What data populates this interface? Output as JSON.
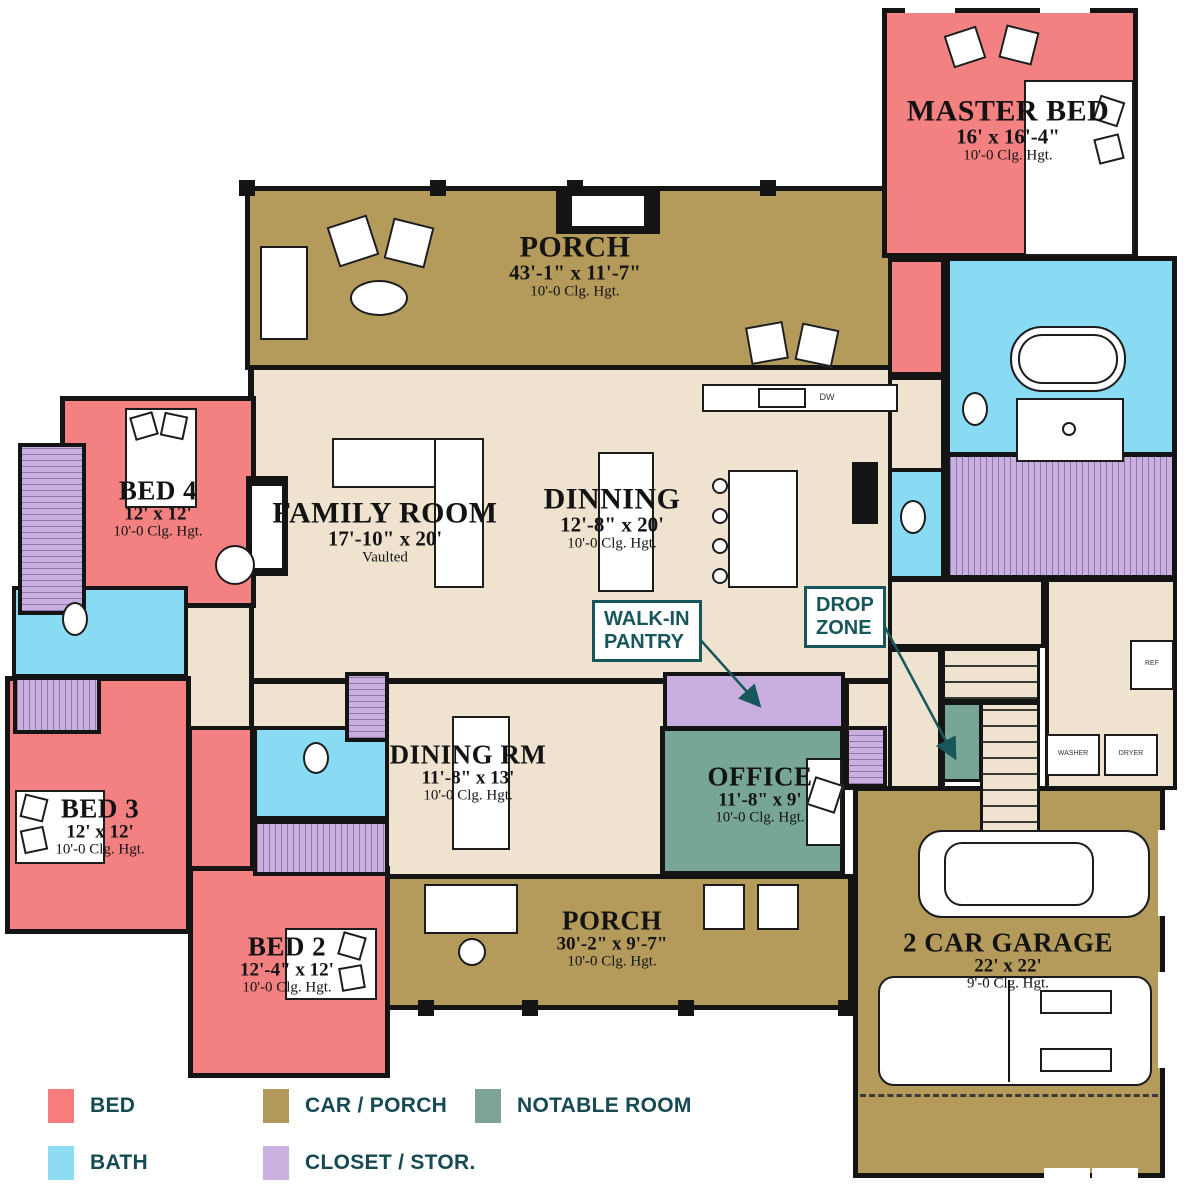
{
  "rooms": {
    "porch_top": {
      "name": "PORCH",
      "dims": "43'-1\" x 11'-7\"",
      "clg": "10'-0 Clg. Hgt."
    },
    "master_bed": {
      "name": "MASTER BED",
      "dims": "16' x 16'-4\"",
      "clg": "10'-0 Clg. Hgt."
    },
    "family_room": {
      "name": "FAMILY ROOM",
      "dims": "17'-10\" x 20'",
      "sub": "Vaulted"
    },
    "dinning": {
      "name": "DINNING",
      "dims": "12'-8\" x 20'",
      "clg": "10'-0 Clg. Hgt."
    },
    "dining_rm": {
      "name": "DINING RM",
      "dims": "11'-8\" x 13'",
      "clg": "10'-0 Clg. Hgt."
    },
    "office": {
      "name": "OFFICE",
      "dims": "11'-8\" x 9'",
      "clg": "10'-0 Clg. Hgt."
    },
    "bed4": {
      "name": "BED 4",
      "dims": "12' x 12'",
      "clg": "10'-0 Clg. Hgt."
    },
    "bed3": {
      "name": "BED 3",
      "dims": "12' x 12'",
      "clg": "10'-0 Clg. Hgt."
    },
    "bed2": {
      "name": "BED 2",
      "dims": "12'-4\" x 12'",
      "clg": "10'-0 Clg. Hgt."
    },
    "porch_bottom": {
      "name": "PORCH",
      "dims": "30'-2\" x 9'-7\"",
      "clg": "10'-0 Clg. Hgt."
    },
    "garage": {
      "name": "2 CAR GARAGE",
      "dims": "22' x 22'",
      "clg": "9'-0 Clg. Hgt."
    }
  },
  "callouts": {
    "walk_in_pantry": {
      "line1": "WALK-IN",
      "line2": "PANTRY"
    },
    "drop_zone": {
      "line1": "DROP",
      "line2": "ZONE"
    }
  },
  "appliances": {
    "ref": "REF",
    "washer": "WASHER",
    "dryer": "DRYER",
    "dw": "DW"
  },
  "legend": {
    "items": [
      {
        "id": "bed",
        "label": "BED",
        "color": "#F57D7D"
      },
      {
        "id": "bath",
        "label": "BATH",
        "color": "#8EDCF2"
      },
      {
        "id": "car_porch",
        "label": "CAR / PORCH",
        "color": "#B3985C"
      },
      {
        "id": "closet_stor",
        "label": "CLOSET / STOR.",
        "color": "#C9B2E0"
      },
      {
        "id": "notable_room",
        "label": "NOTABLE ROOM",
        "color": "#7FA496"
      }
    ]
  },
  "colors": {
    "bed": "#F57D7D",
    "bath": "#8EDCF2",
    "car_porch": "#B3985C",
    "closet_stor": "#C9B2E0",
    "notable_room": "#7FA496",
    "floor": "#EFE3D0",
    "wall": "#141414",
    "label_text": "#131313",
    "callout_text": "#17565A"
  }
}
